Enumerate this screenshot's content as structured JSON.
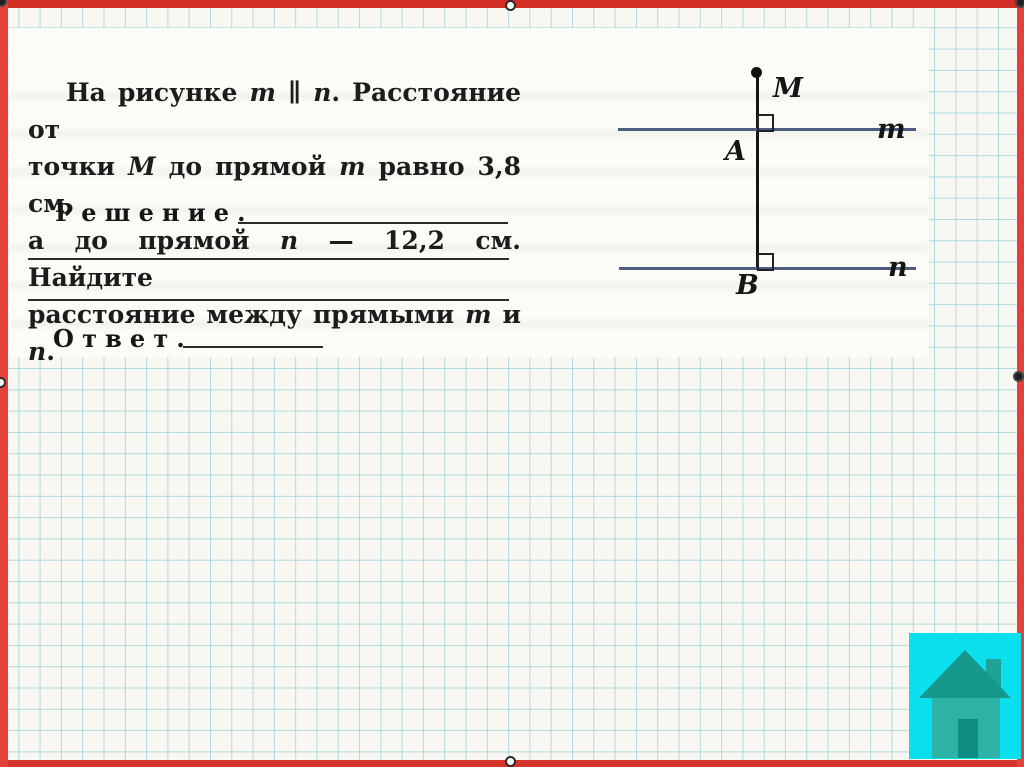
{
  "slide": {
    "kind": "presentation-slide",
    "colors": {
      "frame_red": "#dd362c",
      "grid_line": "#76c4d2",
      "paper": "#f8f7f2",
      "card": "#fcfcf7"
    }
  },
  "card": {
    "problem": {
      "segments": [
        {
          "t": "На рисунке "
        },
        {
          "t": "m",
          "i": true
        },
        {
          "t": " ∥ "
        },
        {
          "t": "n",
          "i": true
        },
        {
          "t": ". Расстояние от",
          "br": true
        },
        {
          "t": "точки "
        },
        {
          "t": "M",
          "i": true
        },
        {
          "t": " до прямой "
        },
        {
          "t": "m",
          "i": true
        },
        {
          "t": " равно 3,8 см,",
          "br": true
        },
        {
          "t": "а до прямой "
        },
        {
          "t": "n",
          "i": true
        },
        {
          "t": " — 12,2 см. Найдите",
          "br": true
        },
        {
          "t": "расстояние между прямыми "
        },
        {
          "t": "m",
          "i": true
        },
        {
          "t": " и "
        },
        {
          "t": "n",
          "i": true
        },
        {
          "t": "."
        }
      ],
      "distance_to_m_cm": "3,8",
      "distance_to_n_cm": "12,2"
    },
    "solution_label": "Решение.",
    "answer_label": "Ответ."
  },
  "diagram": {
    "point_m_label": "M",
    "line_m_label": "m",
    "point_a_label": "A",
    "line_n_label": "n",
    "point_b_label": "B",
    "line_color": "#4d5d80",
    "perpendicular_color": "#141414"
  },
  "home_button": {
    "icon": "house",
    "background": "#0adfee",
    "roof_color": "#17988c",
    "body_color": "#2fb2a6",
    "door_color": "#0d8d81"
  }
}
